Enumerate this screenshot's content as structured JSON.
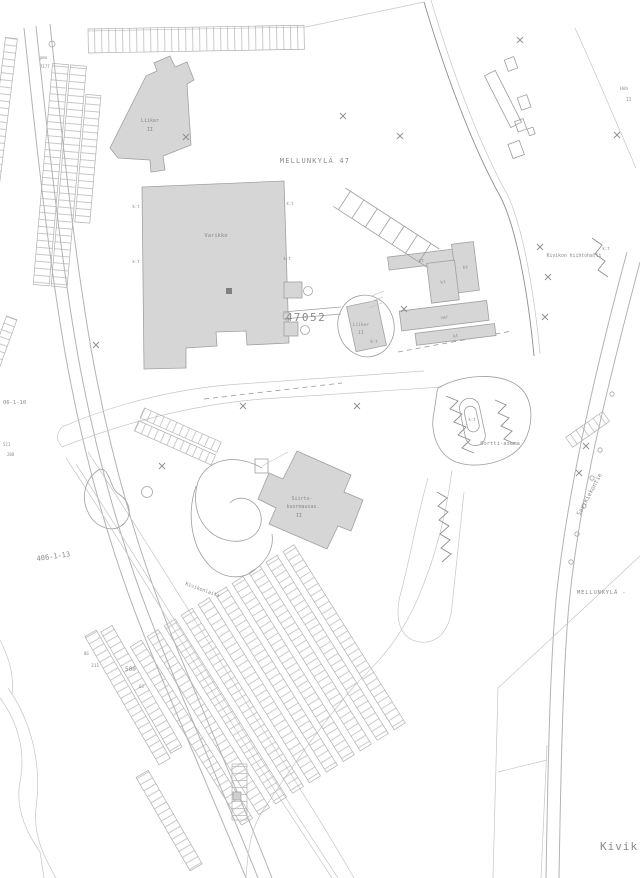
{
  "colors": {
    "background": "#ffffff",
    "building_fill": "#d6d6d6",
    "building_stroke": "#a0a0a0",
    "line": "#b3b3b3",
    "dark_line": "#8f8f8f",
    "text": "#8a8a8a",
    "faint_text": "#b5b5b5"
  },
  "map": {
    "district_label": "MELLUNKYLÄ 47",
    "district_label_right": "MELLUNKYLÄ -",
    "plot_number": "47052",
    "area_name_bottom": "Kivik",
    "buildings": {
      "varikko": "Varikko",
      "liiker_north": {
        "line1": "Liiker",
        "line2": "II"
      },
      "liiker_central": {
        "line1": "Liiker",
        "line2": "II"
      },
      "siirtokuormaus": {
        "line1": "Siirto-",
        "line2": "kuormausas.",
        "line3": "II"
      },
      "hiihtohalli": "Kivikon hiihtohalli",
      "sortti": "Sortti-asema",
      "hoh": {
        "line1": "Höh",
        "line2": "II"
      }
    },
    "streets": {
      "savikiekontie": "Savikiekontie",
      "kivikonlaita": "Kivikonlaita"
    },
    "annotations": {
      "kt": "kt",
      "kt_colon": "k:t",
      "var": "var",
      "parcel_code_1": "406-1-13",
      "parcel_code_2": "06-1-10",
      "num_521": "521",
      "num_208": "208",
      "num_pmo": "pmo",
      "num_7177": "7177",
      "num_86": "86",
      "num_311": "311",
      "num_500": "500",
      "num_63": "63"
    }
  }
}
